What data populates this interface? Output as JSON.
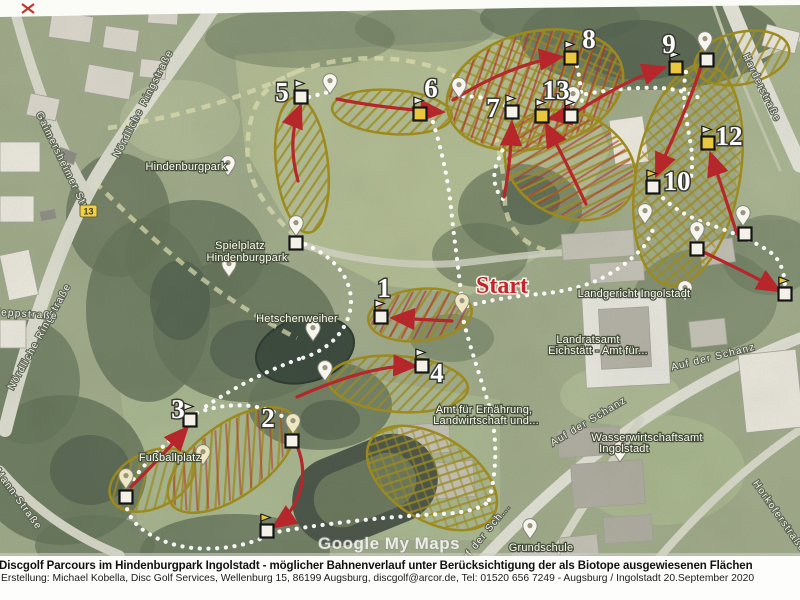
{
  "caption": {
    "title": "Discgolf Parcours im Hindenburgpark Ingolstadt - möglicher Bahnenverlauf unter Berücksichtigung der als Biotope ausgewiesenen Flächen",
    "credit": "Erstellung: Michael Kobella, Disc Golf Services, Wellenburg 15, 86199 Augsburg, discgolf@arcor.de, Tel: 01520 656 7249 - Augsburg / Ingolstadt 20.September 2020"
  },
  "map": {
    "watermark": "Google My Maps",
    "start_label": "Start",
    "road_shield": "13",
    "holes": [
      {
        "number": "1",
        "x": 384,
        "y": 291
      },
      {
        "number": "2",
        "x": 268,
        "y": 421
      },
      {
        "number": "3",
        "x": 178,
        "y": 412
      },
      {
        "number": "4",
        "x": 437,
        "y": 376
      },
      {
        "number": "5",
        "x": 282,
        "y": 95
      },
      {
        "number": "6",
        "x": 431,
        "y": 91
      },
      {
        "number": "7",
        "x": 493,
        "y": 111
      },
      {
        "number": "8",
        "x": 589,
        "y": 42
      },
      {
        "number": "9",
        "x": 669,
        "y": 47
      },
      {
        "number": "10",
        "x": 677,
        "y": 184
      },
      {
        "number": "12",
        "x": 729,
        "y": 139
      },
      {
        "number": "13",
        "x": 556,
        "y": 93
      }
    ],
    "markers": [
      {
        "x": 381,
        "y": 317,
        "box": "white",
        "flag": true,
        "pennant": "white"
      },
      {
        "x": 296,
        "y": 243,
        "box": "white",
        "flag": false,
        "pennant": "white"
      },
      {
        "x": 292,
        "y": 441,
        "box": "white",
        "flag": false,
        "pennant": "white"
      },
      {
        "x": 267,
        "y": 531,
        "box": "white",
        "flag": true,
        "pennant": "yellow"
      },
      {
        "x": 190,
        "y": 420,
        "box": "white",
        "flag": true,
        "pennant": "white"
      },
      {
        "x": 126,
        "y": 497,
        "box": "white",
        "flag": false,
        "pennant": "white"
      },
      {
        "x": 422,
        "y": 366,
        "box": "white",
        "flag": true,
        "pennant": "white"
      },
      {
        "x": 301,
        "y": 97,
        "box": "white",
        "flag": true,
        "pennant": "white"
      },
      {
        "x": 420,
        "y": 114,
        "box": "yellow",
        "flag": true,
        "pennant": "white"
      },
      {
        "x": 512,
        "y": 112,
        "box": "white",
        "flag": true,
        "pennant": "white"
      },
      {
        "x": 571,
        "y": 58,
        "box": "yellow",
        "flag": true,
        "pennant": "white"
      },
      {
        "x": 676,
        "y": 68,
        "box": "yellow",
        "flag": true,
        "pennant": "white"
      },
      {
        "x": 707,
        "y": 60,
        "box": "white",
        "flag": false,
        "pennant": "white"
      },
      {
        "x": 653,
        "y": 187,
        "box": "white",
        "flag": true,
        "pennant": "yellow"
      },
      {
        "x": 708,
        "y": 143,
        "box": "yellow",
        "flag": true,
        "pennant": "white"
      },
      {
        "x": 542,
        "y": 116,
        "box": "yellow",
        "flag": true,
        "pennant": "white"
      },
      {
        "x": 571,
        "y": 116,
        "box": "white",
        "flag": true,
        "pennant": "white"
      },
      {
        "x": 785,
        "y": 294,
        "box": "white",
        "flag": true,
        "pennant": "yellow"
      },
      {
        "x": 745,
        "y": 234,
        "box": "white",
        "flag": false,
        "pennant": "white"
      },
      {
        "x": 697,
        "y": 249,
        "box": "white",
        "flag": false,
        "pennant": "white"
      }
    ],
    "pins": [
      {
        "x": 228,
        "y": 176,
        "color": "white"
      },
      {
        "x": 229,
        "y": 277,
        "color": "white"
      },
      {
        "x": 313,
        "y": 341,
        "color": "white"
      },
      {
        "x": 203,
        "y": 465,
        "color": "cream"
      },
      {
        "x": 296,
        "y": 236,
        "color": "white"
      },
      {
        "x": 330,
        "y": 94,
        "color": "white"
      },
      {
        "x": 459,
        "y": 98,
        "color": "white"
      },
      {
        "x": 573,
        "y": 107,
        "color": "white"
      },
      {
        "x": 705,
        "y": 52,
        "color": "white"
      },
      {
        "x": 462,
        "y": 314,
        "color": "cream"
      },
      {
        "x": 293,
        "y": 434,
        "color": "cream"
      },
      {
        "x": 126,
        "y": 489,
        "color": "cream"
      },
      {
        "x": 325,
        "y": 381,
        "color": "white"
      },
      {
        "x": 645,
        "y": 224,
        "color": "white"
      },
      {
        "x": 743,
        "y": 226,
        "color": "white"
      },
      {
        "x": 697,
        "y": 242,
        "color": "white"
      },
      {
        "x": 685,
        "y": 301,
        "color": "white"
      },
      {
        "x": 620,
        "y": 462,
        "color": "white"
      },
      {
        "x": 530,
        "y": 539,
        "color": "white"
      }
    ],
    "place_labels": [
      {
        "text": "Hindenburgpark",
        "x": 186,
        "y": 170
      },
      {
        "text": "Spielplatz",
        "x": 240,
        "y": 249
      },
      {
        "text": "Hindenburgpark",
        "x": 247,
        "y": 261
      },
      {
        "text": "Hetschenweiher",
        "x": 297,
        "y": 322
      },
      {
        "text": "Fußballplatz",
        "x": 170,
        "y": 461
      },
      {
        "text": "Landgericht Ingolstadt",
        "x": 634,
        "y": 297
      },
      {
        "text": "Landratsamt",
        "x": 588,
        "y": 343
      },
      {
        "text": "Eichstätt - Amt für...",
        "x": 598,
        "y": 354
      },
      {
        "text": "Amt für Ernährung,",
        "x": 484,
        "y": 413
      },
      {
        "text": "Landwirtschaft und...",
        "x": 486,
        "y": 424
      },
      {
        "text": "Wasserwirtschaftsamt",
        "x": 647,
        "y": 441
      },
      {
        "text": "Ingolstadt",
        "x": 624,
        "y": 452
      },
      {
        "text": "Grundschule",
        "x": 541,
        "y": 551
      }
    ],
    "street_labels": [
      {
        "text": "Gaimersheimer Str.",
        "x": 60,
        "y": 163,
        "rot": 64
      },
      {
        "text": "Nördliche Ringstraße",
        "x": 146,
        "y": 105,
        "rot": -63
      },
      {
        "text": "Nördliche Ringstraße",
        "x": 42,
        "y": 338,
        "rot": -61
      },
      {
        "text": "Heppstraße",
        "x": 25,
        "y": 317,
        "rot": 4
      },
      {
        "text": "Mann-Straße",
        "x": 16,
        "y": 501,
        "rot": 54
      },
      {
        "text": "Harderstraße",
        "x": 759,
        "y": 89,
        "rot": 64
      },
      {
        "text": "Auf der Schanz",
        "x": 714,
        "y": 360,
        "rot": -14
      },
      {
        "text": "Auf der Schanz",
        "x": 590,
        "y": 424,
        "rot": -31
      },
      {
        "text": "Auf der Sch...",
        "x": 486,
        "y": 537,
        "rot": -51
      },
      {
        "text": "Horkoferstraße",
        "x": 777,
        "y": 518,
        "rot": 55
      }
    ],
    "colors": {
      "arrow_red": "#b5272b",
      "biotope_olive": "#9c8a1f",
      "biotope_red": "#b3362e",
      "tee_yellow": "#eac83d",
      "start_red": "#c4242b",
      "path_dot": "#ffffff"
    }
  }
}
